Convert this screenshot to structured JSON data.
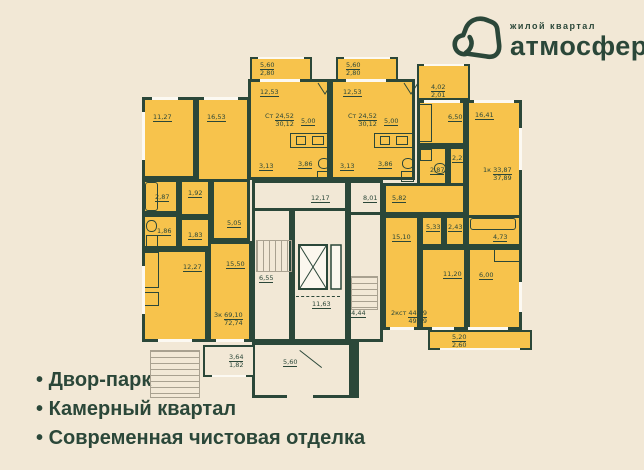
{
  "logo": {
    "tagline": "жилой квартал",
    "brand": "атмосфера"
  },
  "features": {
    "f1": "Двор-парк",
    "f2": "Камерный квартал",
    "f3": "Современная чистовая отделка"
  },
  "plan": {
    "rooms": {
      "r1127": "11,27",
      "r1653": "16,53",
      "r287": "2,87",
      "r192": "1,92",
      "r186": "1,86",
      "r183": "1,83",
      "r505": "5,05",
      "r1227": "12,27",
      "r1550": "15,50",
      "r1253": "12,53",
      "r500": "5,00",
      "r313": "3,13",
      "r386": "3,86",
      "r650": "6,50",
      "r1641": "16,41",
      "r227": "2,27",
      "r582": "5,82",
      "r1510": "15,10",
      "r533": "5,33",
      "r243": "2,43",
      "r473": "4,73",
      "r1120": "11,20",
      "r600": "6,00",
      "r1217": "12,17",
      "r801": "8,01",
      "r655": "6,55",
      "r1163": "11,63",
      "r1444": "14,44",
      "r560": "5,60"
    },
    "balconies": {
      "b560": {
        "a1": "5,60",
        "a2": "2,80"
      },
      "b402": {
        "a1": "4,02",
        "a2": "2,01"
      },
      "b520": {
        "a1": "5,20",
        "a2": "2,60"
      },
      "b364": {
        "a1": "3,64",
        "a2": "1,82"
      }
    },
    "apartments": {
      "studio": {
        "type": "Ст",
        "a1": "24,52",
        "a2": "30,12"
      },
      "one": {
        "type": "1к",
        "a1": "33,87",
        "a2": "37,89"
      },
      "twost": {
        "type": "2кст",
        "a1": "44,79",
        "a2": "49,99"
      },
      "three": {
        "type": "3к",
        "a1": "69,10",
        "a2": "72,74"
      }
    }
  },
  "colors": {
    "background": "#f2e8d6",
    "room": "#f7c34c",
    "wall": "#2b4739",
    "lines": "#a9a190",
    "window": "#fcf9f2"
  }
}
